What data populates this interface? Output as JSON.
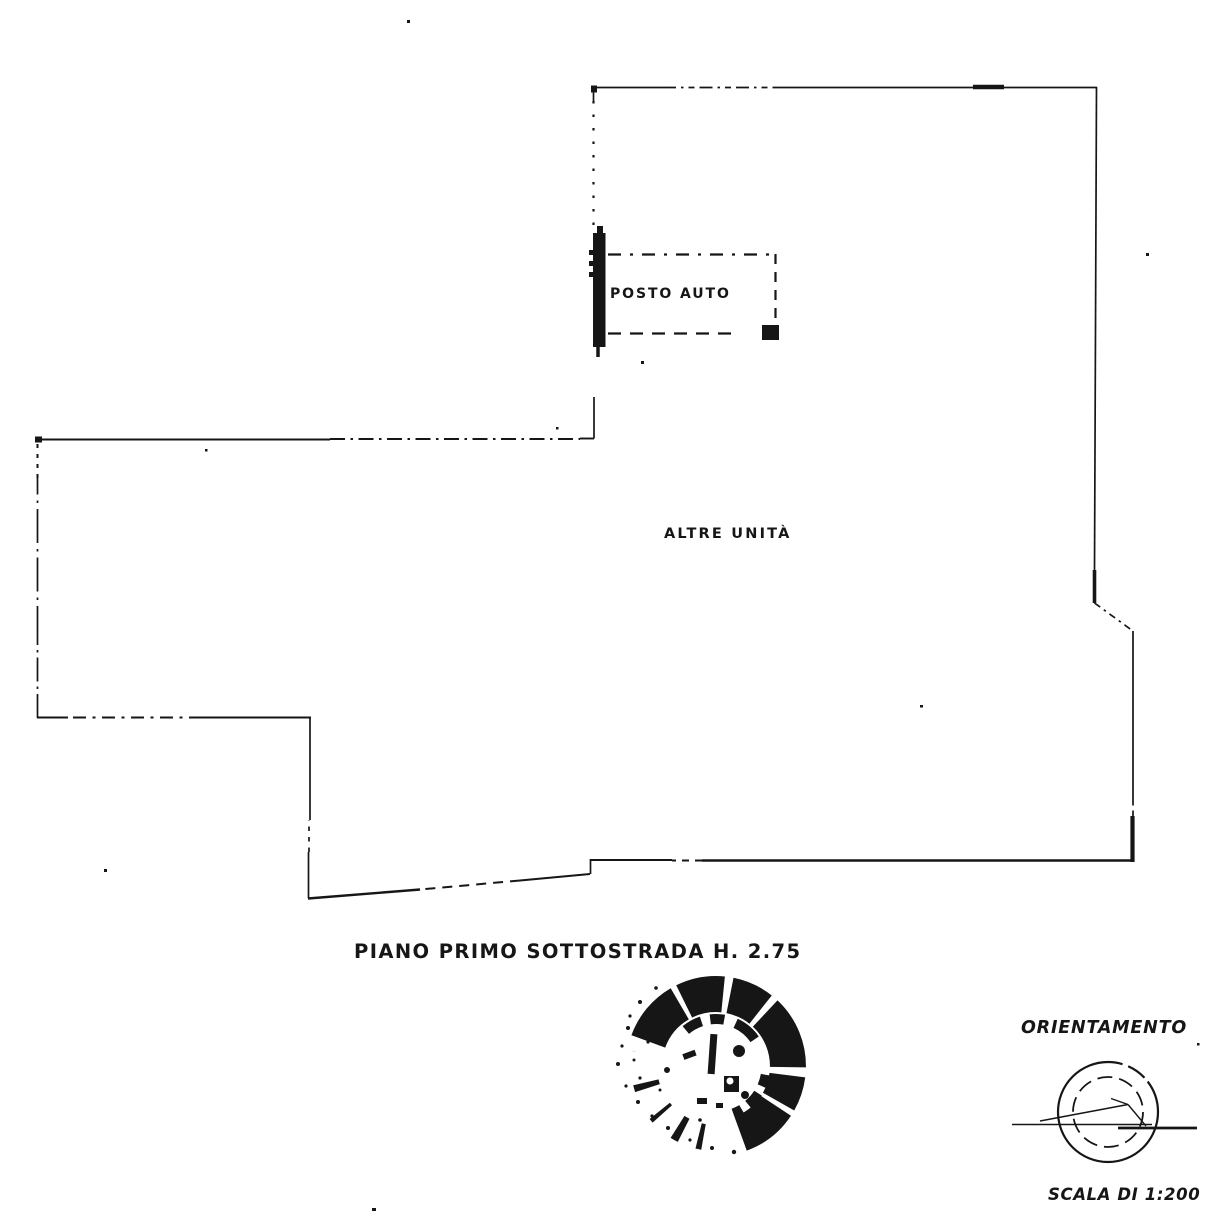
{
  "colors": {
    "ink": "#161616",
    "paper": "#ffffff"
  },
  "plan": {
    "labels": {
      "posto_auto": "POSTO AUTO",
      "altre_unita": "ALTRE UNITÀ"
    },
    "caption": "PIANO PRIMO SOTTOSTRADA H. 2.75"
  },
  "orientation": {
    "title": "ORIENTAMENTO",
    "scale": "SCALA DI 1:200"
  },
  "stamp": {
    "description": "illegible-round-ink-stamp"
  }
}
